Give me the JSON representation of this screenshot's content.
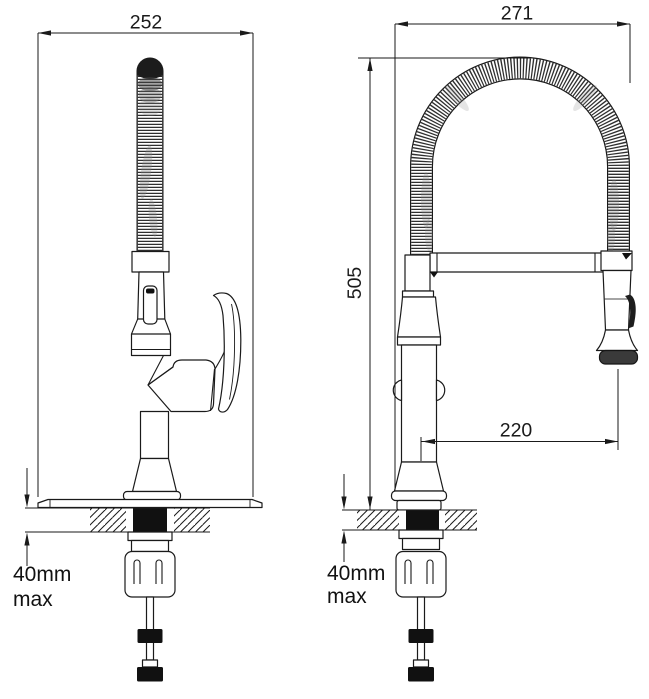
{
  "drawing": {
    "colors": {
      "line": "#1a1a1a",
      "background": "#ffffff",
      "hose_coil": "#2f2f2f",
      "counter_shank": "#111111"
    }
  },
  "dimensions": {
    "side_overall_width": "252",
    "front_overall_width": "271",
    "overall_height": "505",
    "spout_reach": "220",
    "side_counter_max": [
      "40mm",
      "max"
    ],
    "front_counter_max": [
      "40mm",
      "max"
    ]
  }
}
